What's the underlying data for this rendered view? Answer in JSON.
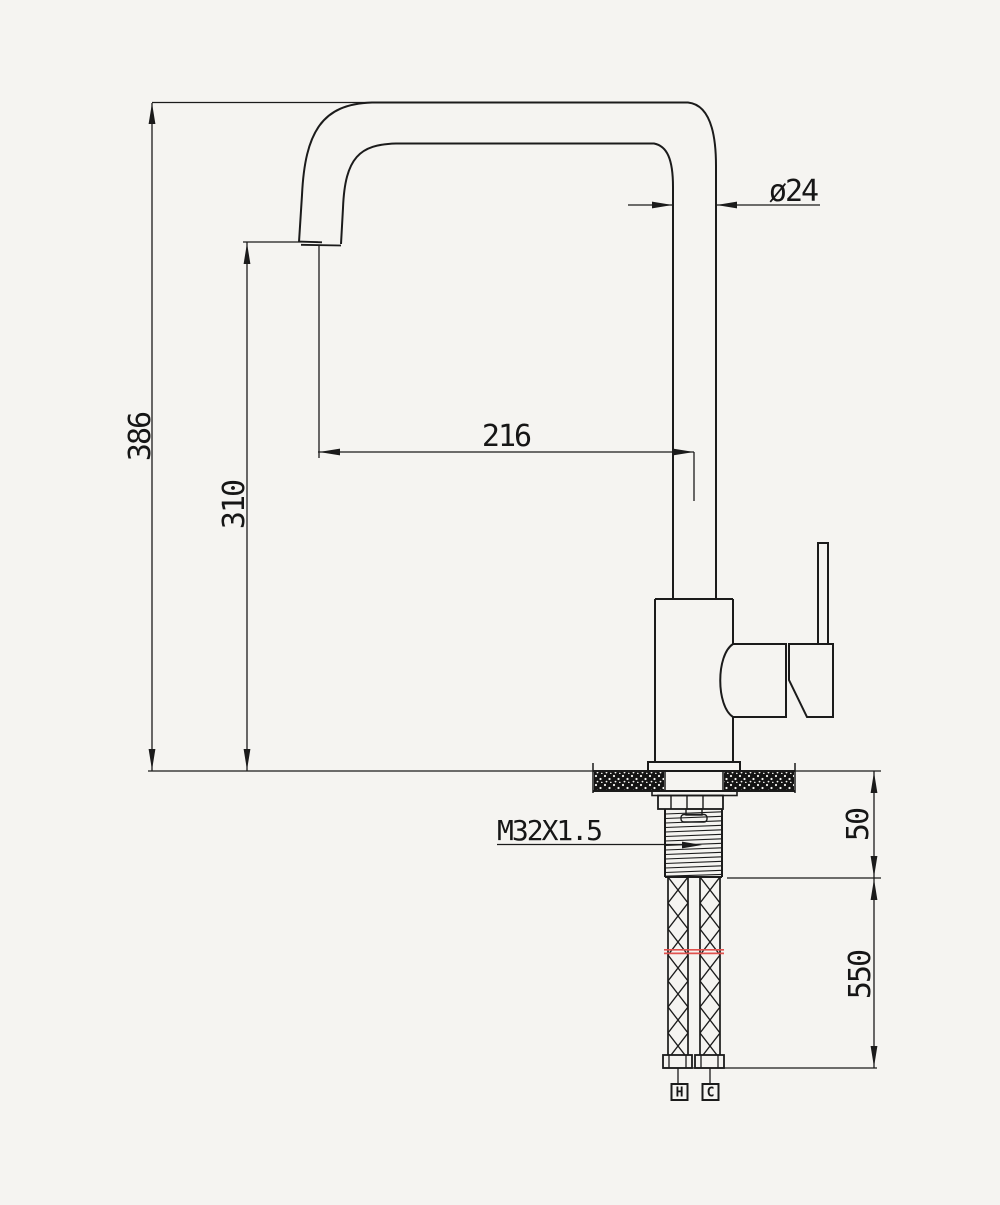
{
  "meta": {
    "background": "#f5f4f1",
    "line_color": "#1b1b1b",
    "break_line_color": "#e0524e"
  },
  "dimensions": {
    "overall_height": "386",
    "spout_height": "310",
    "spout_reach": "216",
    "pipe_diameter": "ø24",
    "mount_thread": "M32X1.5",
    "deck_section": "50",
    "hose_length": "550"
  },
  "hose_labels": {
    "hot": "H",
    "cold": "C"
  }
}
